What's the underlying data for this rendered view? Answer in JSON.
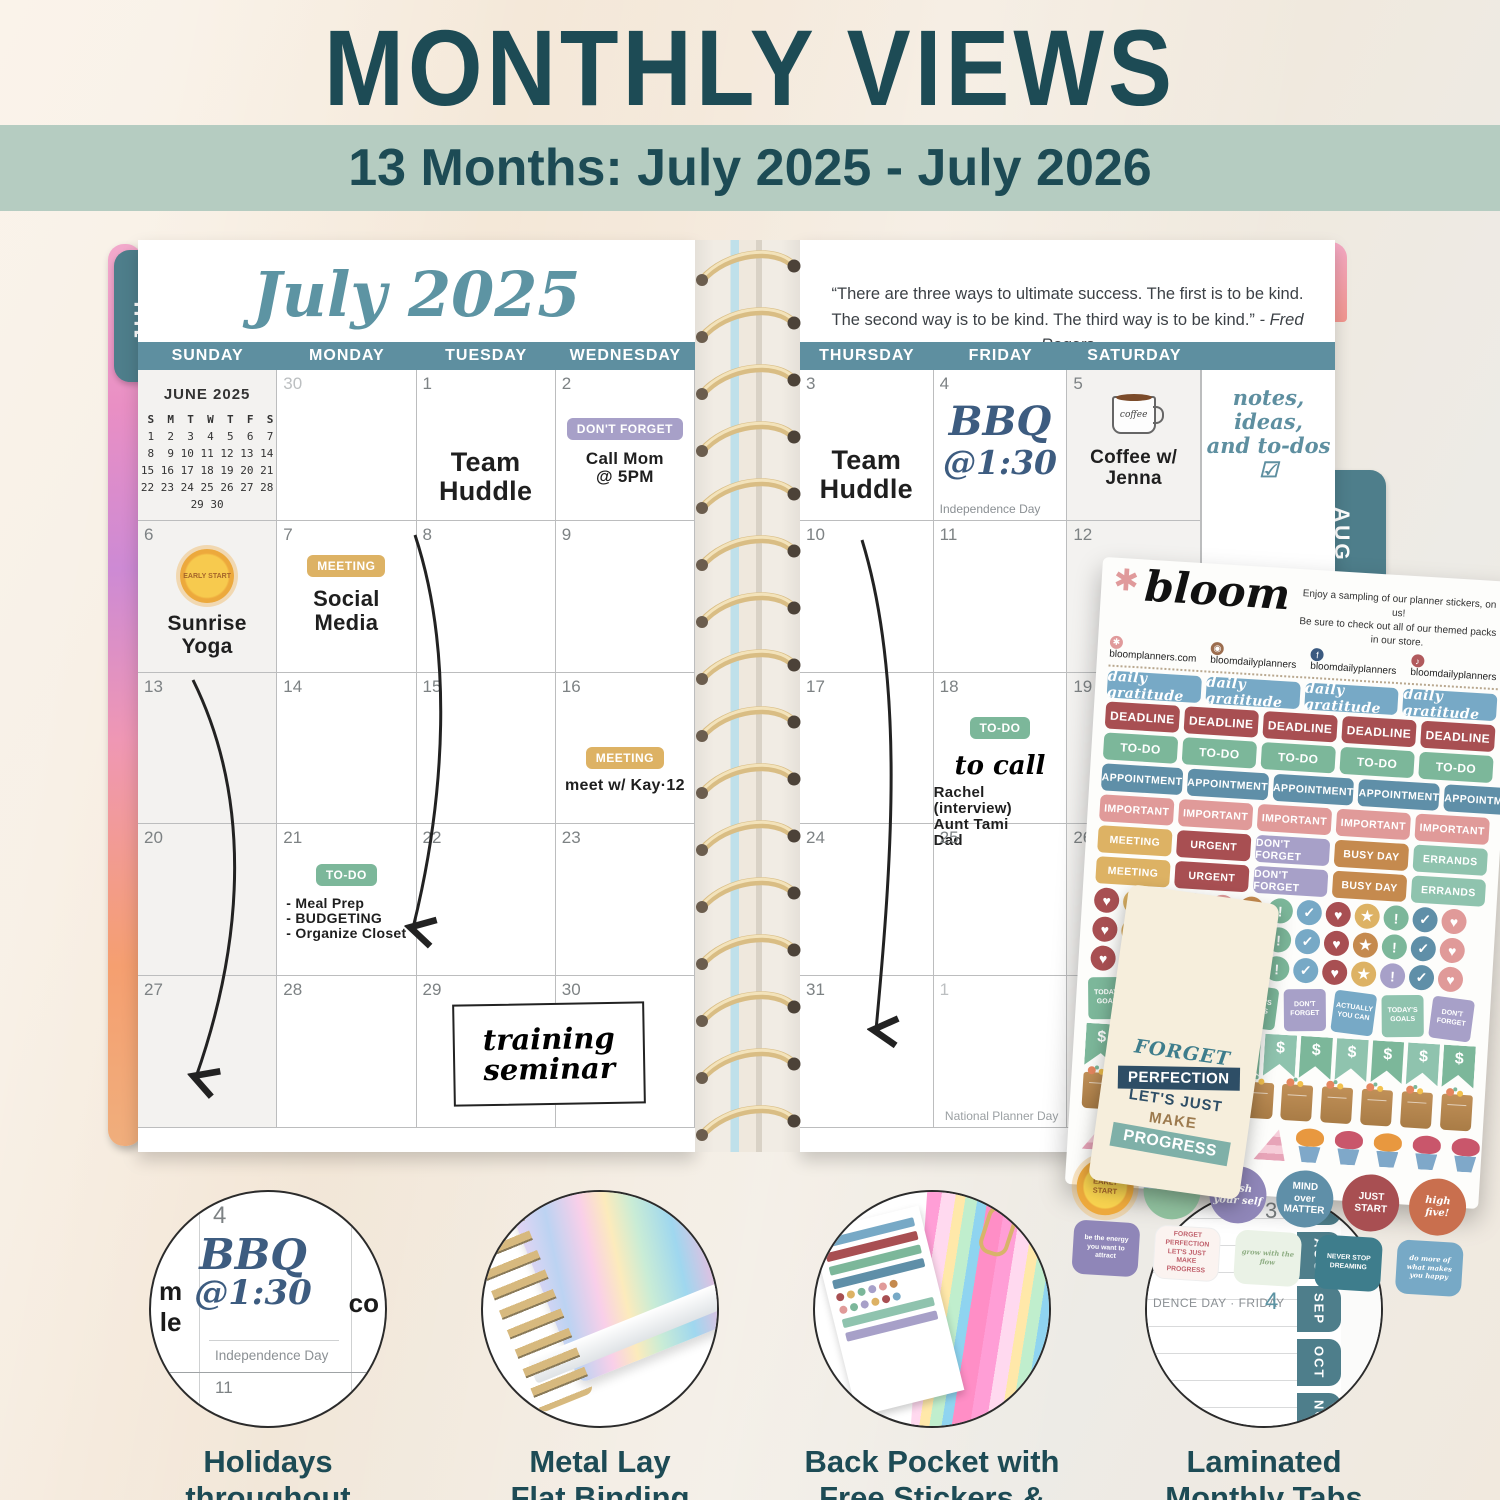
{
  "header": {
    "title": "MONTHLY VIEWS",
    "subtitle": "13 Months: July 2025 - July 2026"
  },
  "colors": {
    "title_teal": "#1d4b55",
    "band_green": "#b5ccc1",
    "day_band_teal": "#5e8fa0",
    "tab_teal": "#4e7e8b",
    "month_script_teal": "#5d94a3",
    "sticker_maroon": "#a84f52",
    "sticker_gold": "#ddb264",
    "sticker_green": "#7cb79a",
    "sticker_blue": "#5f8fa8",
    "sticker_lavender": "#a7a0c8",
    "sticker_pink": "#e09a99",
    "sticker_orange": "#c58a4e",
    "sticker_seafoam": "#8fc3ae",
    "sticker_sky_blue": "#77a9c6"
  },
  "planner": {
    "left_tab": "JUL",
    "right_tabs": [
      "AUG",
      "SEP",
      "OCT",
      "NOV"
    ],
    "month_title": "July 2025",
    "quote": {
      "l1": "“There are three ways to ultimate success. The first is to be kind.",
      "l2": "The second way is to be kind. The third way is to be kind.”",
      "attrib": "- Fred Rogers"
    },
    "day_headers_left": [
      "SUNDAY",
      "MONDAY",
      "TUESDAY",
      "WEDNESDAY"
    ],
    "day_headers_right": [
      "THURSDAY",
      "FRIDAY",
      "SATURDAY"
    ],
    "june_mini": {
      "title": "JUNE 2025",
      "dow": " S  M  T  W  T  F  S",
      "weeks": [
        " 1  2  3  4  5  6  7",
        " 8  9 10 11 12 13 14",
        "15 16 17 18 19 20 21",
        "22 23 24 25 26 27 28",
        "29 30"
      ]
    },
    "aug_mini": {
      "partial": "A\nS  M\n 3  4\n10  1\n17  1\n24  2\n31"
    },
    "left_grid": {
      "r1": {
        "c2": "30",
        "c3": "1",
        "c4": "2"
      },
      "r2": {
        "c1": "6",
        "c2": "7",
        "c3": "8",
        "c4": "9"
      },
      "r3": {
        "c1": "13",
        "c2": "14",
        "c3": "15",
        "c4": "16"
      },
      "r4": {
        "c1": "20",
        "c2": "21",
        "c3": "22",
        "c4": "23"
      },
      "r5": {
        "c1": "27",
        "c2": "28",
        "c3": "29",
        "c4": "30"
      }
    },
    "right_grid": {
      "r1": {
        "c1": "3",
        "c2": "4",
        "c3": "5"
      },
      "r2": {
        "c1": "10",
        "c2": "11",
        "c3": "12"
      },
      "r3": {
        "c1": "17",
        "c2": "18",
        "c3": "19"
      },
      "r4": {
        "c1": "24",
        "c2": "25",
        "c3": "26"
      },
      "r5": {
        "c1": "31",
        "c2": "1"
      }
    },
    "entries": {
      "team_huddle": "Team\nHuddle",
      "dont_forget": "DON'T FORGET",
      "call_mom": "Call Mom\n@ 5PM",
      "sun_badge": "EARLY\nSTART",
      "sunrise_yoga": "Sunrise\nYoga",
      "meeting": "MEETING",
      "social_media": "Social\nMedia",
      "meet_kay": "meet w/ Kay·12",
      "todo": "TO-DO",
      "todo_list": "- Meal Prep\n- BUDGETING\n- Organize Closet",
      "training_seminar": "training\nseminar",
      "bbq": "BBQ",
      "bbq_time": "@1:30",
      "independence_day": "Independence Day",
      "coffee_mug": "coffee",
      "coffee_jenna": "Coffee w/\nJenna",
      "to_call": "to call",
      "to_call_list": "Rachel (interview)\nAunt Tami\nDad",
      "national_planner_day": "National Planner Day",
      "notes_art": "notes, ideas,\nand to-dos ☑",
      "misc_to_do": "Misc to do",
      "laundry": "laundry",
      "ironing": "ironing"
    }
  },
  "sticker_sheet": {
    "brand": "bloom",
    "blurb_l1": "Enjoy a sampling of our planner stickers, on us!",
    "blurb_l2": "Be sure to check out all of our themed packs in our store.",
    "social": {
      "website": "bloomplanners.com",
      "instagram": "bloomdailyplanners",
      "facebook": "bloomdailyplanners",
      "tiktok": "bloomdailyplanners"
    },
    "labels": {
      "daily_gratitude": "daily gratitude",
      "deadline": "DEADLINE",
      "todo": "TO-DO",
      "appointment": "APPOINTMENT",
      "important": "IMPORTANT",
      "meeting": "MEETING",
      "urgent": "URGENT",
      "dont_forget": "DON'T FORGET",
      "busy_day": "BUSY DAY",
      "errands": "ERRANDS"
    },
    "glyphs": {
      "heart": "♥",
      "star": "★",
      "bang": "!",
      "check": "✓",
      "dollar": "$"
    },
    "pnotes": {
      "goals": "TODAY'S GOALS",
      "forget": "DON'T FORGET",
      "can": "ACTUALLY YOU CAN"
    },
    "rounds": {
      "sun": "EARLY START",
      "push": "push your self",
      "mind": "MIND over MATTER",
      "start": "JUST START",
      "five": "high five!"
    },
    "quotes": {
      "energy": "be the energy you want to attract",
      "progress": "FORGET PERFECTION LET'S JUST MAKE PROGRESS",
      "flow": "grow with the flow",
      "dream": "NEVER STOP DREAMING",
      "happy": "do more of what makes you happy"
    }
  },
  "bookmark": {
    "l1": "FORGET",
    "l2": "PERFECTION",
    "l3": "LET'S JUST",
    "l4": "MAKE",
    "l5": "PROGRESS"
  },
  "features": {
    "f1": {
      "cap1": "Holidays",
      "cap2": "throughout",
      "day": "4",
      "bbq": "BBQ",
      "time": "@1:30",
      "holiday": "Independence Day",
      "d11": "11",
      "d12": "12",
      "hand_left": "m\nle",
      "hand_right": "co"
    },
    "f2": {
      "cap1": "Metal Lay",
      "cap2": "Flat Binding"
    },
    "f3": {
      "cap1": "Back Pocket with",
      "cap2": "Free Stickers & Bookmark"
    },
    "f4": {
      "cap1": "Laminated",
      "cap2": "Monthly Tabs",
      "line": "DENCE DAY · FRIDAY",
      "day": "4",
      "top_day": "3",
      "tabs": [
        "JUL",
        "AUG",
        "SEP",
        "OCT",
        "NOV"
      ]
    }
  }
}
